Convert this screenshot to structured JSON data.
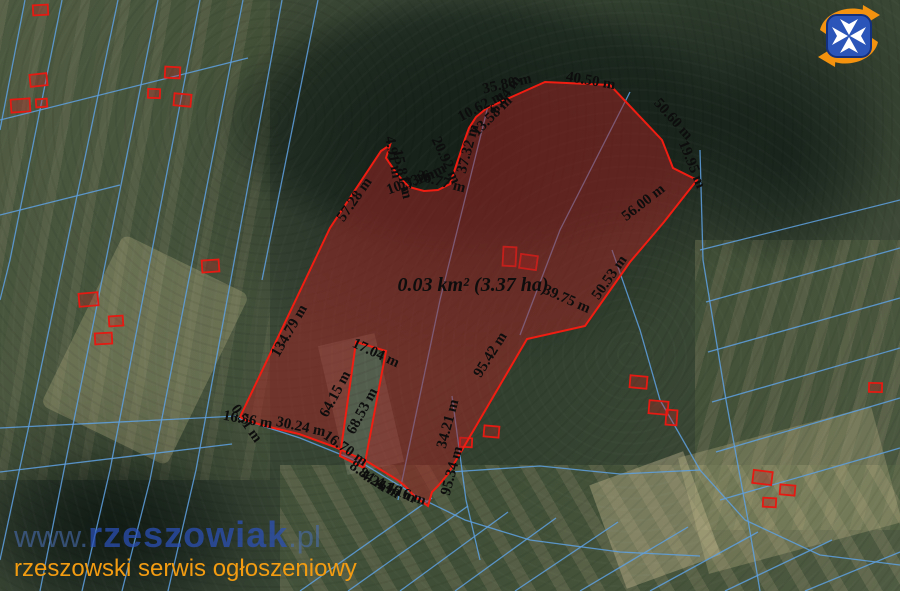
{
  "map": {
    "area_label": "0.03 km² (3.37 ha)",
    "measurements": [
      {
        "text": "134.79 m",
        "x": 293,
        "y": 333,
        "rot": -60
      },
      {
        "text": "57.28 m",
        "x": 358,
        "y": 202,
        "rot": -55
      },
      {
        "text": "4.91 m",
        "x": 389,
        "y": 158,
        "rot": 80
      },
      {
        "text": "15.81 m",
        "x": 398,
        "y": 175,
        "rot": 78
      },
      {
        "text": "10.33 m",
        "x": 412,
        "y": 186,
        "rot": -20
      },
      {
        "text": "27.16 m",
        "x": 424,
        "y": 182,
        "rot": -25
      },
      {
        "text": "36.77 m",
        "x": 440,
        "y": 186,
        "rot": 15
      },
      {
        "text": "20.92 m",
        "x": 442,
        "y": 162,
        "rot": 65
      },
      {
        "text": "37.32 m",
        "x": 472,
        "y": 150,
        "rot": -75
      },
      {
        "text": "10.62 m",
        "x": 483,
        "y": 110,
        "rot": -28
      },
      {
        "text": "13.58 m",
        "x": 495,
        "y": 119,
        "rot": -45
      },
      {
        "text": "6.84 m",
        "x": 509,
        "y": 97,
        "rot": -55
      },
      {
        "text": "35.80 m",
        "x": 508,
        "y": 88,
        "rot": -13
      },
      {
        "text": "40.50 m",
        "x": 590,
        "y": 85,
        "rot": 10
      },
      {
        "text": "50.60 m",
        "x": 670,
        "y": 122,
        "rot": 48
      },
      {
        "text": "19.95 m",
        "x": 688,
        "y": 166,
        "rot": 68
      },
      {
        "text": "56.00 m",
        "x": 646,
        "y": 206,
        "rot": -38
      },
      {
        "text": "50.53 m",
        "x": 613,
        "y": 280,
        "rot": -55
      },
      {
        "text": "39.75 m",
        "x": 565,
        "y": 303,
        "rot": 24
      },
      {
        "text": "95.42 m",
        "x": 494,
        "y": 357,
        "rot": -58
      },
      {
        "text": "17.04 m",
        "x": 374,
        "y": 357,
        "rot": 25
      },
      {
        "text": "64.15 m",
        "x": 339,
        "y": 396,
        "rot": -62
      },
      {
        "text": "68.53 m",
        "x": 366,
        "y": 413,
        "rot": -62
      },
      {
        "text": "34.21 m",
        "x": 452,
        "y": 425,
        "rot": -75
      },
      {
        "text": "95.34 m",
        "x": 456,
        "y": 472,
        "rot": -75
      },
      {
        "text": "0.51 m",
        "x": 243,
        "y": 426,
        "rot": 55
      },
      {
        "text": "16.56 m",
        "x": 247,
        "y": 424,
        "rot": 10
      },
      {
        "text": "30.24 m",
        "x": 300,
        "y": 431,
        "rot": 12
      },
      {
        "text": "16.70 m",
        "x": 343,
        "y": 452,
        "rot": 35
      },
      {
        "text": "8.84 m",
        "x": 366,
        "y": 480,
        "rot": 35
      },
      {
        "text": "4.24 m",
        "x": 378,
        "y": 488,
        "rot": 30
      },
      {
        "text": "4.46 m",
        "x": 394,
        "y": 494,
        "rot": 25
      },
      {
        "text": "1.16 m",
        "x": 404,
        "y": 498,
        "rot": 20
      }
    ],
    "polygon": {
      "fill": "#a62323",
      "fill_opacity": 0.5,
      "stroke": "#f01d12",
      "stroke_width": 2,
      "outer": [
        [
          240,
          417
        ],
        [
          330,
          228
        ],
        [
          381,
          151
        ],
        [
          390,
          145
        ],
        [
          386,
          158
        ],
        [
          397,
          174
        ],
        [
          409,
          187
        ],
        [
          424,
          191
        ],
        [
          438,
          190
        ],
        [
          450,
          184
        ],
        [
          465,
          139
        ],
        [
          469,
          128
        ],
        [
          476,
          117
        ],
        [
          487,
          108
        ],
        [
          545,
          82
        ],
        [
          610,
          85
        ],
        [
          662,
          140
        ],
        [
          673,
          168
        ],
        [
          697,
          180
        ],
        [
          664,
          222
        ],
        [
          630,
          262
        ],
        [
          585,
          326
        ],
        [
          527,
          339
        ],
        [
          448,
          474
        ],
        [
          443,
          480
        ],
        [
          438,
          486
        ],
        [
          432,
          492
        ],
        [
          428,
          506
        ],
        [
          415,
          497
        ],
        [
          407,
          488
        ],
        [
          399,
          481
        ],
        [
          391,
          476
        ],
        [
          368,
          462
        ],
        [
          335,
          447
        ],
        [
          299,
          434
        ],
        [
          265,
          426
        ],
        [
          245,
          420
        ]
      ],
      "hole": [
        [
          356,
          342
        ],
        [
          386,
          351
        ],
        [
          364,
          468
        ],
        [
          340,
          456
        ]
      ]
    },
    "parcel_lines": {
      "color": "#5ea0e0",
      "items": [
        [
          [
            118,
            0
          ],
          [
            28,
            430
          ],
          [
            0,
            560
          ]
        ],
        [
          [
            158,
            0
          ],
          [
            66,
            460
          ],
          [
            40,
            591
          ]
        ],
        [
          [
            200,
            0
          ],
          [
            110,
            470
          ],
          [
            82,
            591
          ]
        ],
        [
          [
            243,
            0
          ],
          [
            150,
            480
          ],
          [
            122,
            591
          ]
        ],
        [
          [
            282,
            0
          ],
          [
            196,
            470
          ],
          [
            168,
            591
          ]
        ],
        [
          [
            318,
            0
          ],
          [
            262,
            280
          ]
        ],
        [
          [
            62,
            0
          ],
          [
            10,
            260
          ],
          [
            0,
            300
          ]
        ],
        [
          [
            25,
            0
          ],
          [
            0,
            130
          ]
        ],
        [
          [
            0,
            120
          ],
          [
            248,
            58
          ]
        ],
        [
          [
            0,
            215
          ],
          [
            120,
            185
          ]
        ],
        [
          [
            0,
            428
          ],
          [
            238,
            416
          ]
        ],
        [
          [
            0,
            472
          ],
          [
            232,
            444
          ]
        ],
        [
          [
            488,
            106
          ],
          [
            440,
            300
          ],
          [
            398,
            500
          ]
        ],
        [
          [
            630,
            92
          ],
          [
            560,
            230
          ],
          [
            520,
            335
          ]
        ],
        [
          [
            612,
            250
          ],
          [
            640,
            330
          ],
          [
            660,
            400
          ],
          [
            700,
            470
          ],
          [
            745,
            520
          ],
          [
            820,
            555
          ],
          [
            900,
            565
          ]
        ],
        [
          [
            700,
            150
          ],
          [
            703,
            260
          ],
          [
            726,
            400
          ],
          [
            748,
            520
          ],
          [
            760,
            591
          ]
        ],
        [
          [
            706,
            302
          ],
          [
            900,
            248
          ]
        ],
        [
          [
            708,
            352
          ],
          [
            900,
            298
          ]
        ],
        [
          [
            712,
            402
          ],
          [
            900,
            348
          ]
        ],
        [
          [
            716,
            452
          ],
          [
            900,
            398
          ]
        ],
        [
          [
            720,
            500
          ],
          [
            900,
            448
          ]
        ],
        [
          [
            700,
            250
          ],
          [
            900,
            200
          ]
        ],
        [
          [
            300,
            591
          ],
          [
            432,
            498
          ]
        ],
        [
          [
            348,
            591
          ],
          [
            468,
            506
          ]
        ],
        [
          [
            400,
            591
          ],
          [
            508,
            512
          ]
        ],
        [
          [
            455,
            591
          ],
          [
            556,
            518
          ]
        ],
        [
          [
            515,
            591
          ],
          [
            618,
            522
          ]
        ],
        [
          [
            580,
            591
          ],
          [
            688,
            527
          ]
        ],
        [
          [
            650,
            591
          ],
          [
            758,
            532
          ]
        ],
        [
          [
            725,
            591
          ],
          [
            832,
            540
          ]
        ],
        [
          [
            805,
            591
          ],
          [
            900,
            552
          ]
        ],
        [
          [
            238,
            418
          ],
          [
            300,
            438
          ],
          [
            362,
            463
          ],
          [
            420,
            498
          ],
          [
            465,
            520
          ],
          [
            530,
            540
          ],
          [
            620,
            552
          ],
          [
            700,
            556
          ]
        ],
        [
          [
            450,
            472
          ],
          [
            540,
            466
          ],
          [
            620,
            474
          ],
          [
            700,
            470
          ]
        ],
        [
          [
            452,
            396
          ],
          [
            466,
            500
          ],
          [
            480,
            560
          ]
        ]
      ]
    },
    "buildings": {
      "color": "#e51a12",
      "items": [
        [
          30,
          74,
          17,
          12,
          -6
        ],
        [
          11,
          99,
          19,
          13,
          -4
        ],
        [
          36,
          99,
          11,
          8,
          -4
        ],
        [
          33,
          5,
          15,
          10,
          -3
        ],
        [
          165,
          67,
          15,
          11,
          3
        ],
        [
          148,
          89,
          12,
          9,
          2
        ],
        [
          174,
          94,
          17,
          12,
          5
        ],
        [
          202,
          260,
          17,
          12,
          -4
        ],
        [
          79,
          293,
          19,
          13,
          -5
        ],
        [
          109,
          316,
          14,
          10,
          -4
        ],
        [
          95,
          333,
          17,
          11,
          -3
        ],
        [
          503,
          247,
          13,
          19,
          3
        ],
        [
          520,
          255,
          17,
          14,
          8
        ],
        [
          484,
          426,
          15,
          11,
          5
        ],
        [
          460,
          438,
          12,
          9,
          3
        ],
        [
          630,
          376,
          17,
          12,
          5
        ],
        [
          649,
          401,
          19,
          13,
          5
        ],
        [
          666,
          410,
          11,
          15,
          4
        ],
        [
          753,
          471,
          19,
          13,
          7
        ],
        [
          780,
          485,
          15,
          10,
          5
        ],
        [
          763,
          498,
          13,
          9,
          3
        ],
        [
          869,
          383,
          13,
          9,
          1
        ]
      ]
    }
  },
  "branding": {
    "url_prefix": "www.",
    "url_brand": "rzeszowiak",
    "url_suffix": ".pl",
    "tagline": "rzeszowski serwis ogłoszeniowy",
    "logo_colors": {
      "arrow": "#f2920f",
      "shield": "#2b55b8",
      "shield_dark": "#12307e",
      "cross": "#ffffff"
    }
  }
}
